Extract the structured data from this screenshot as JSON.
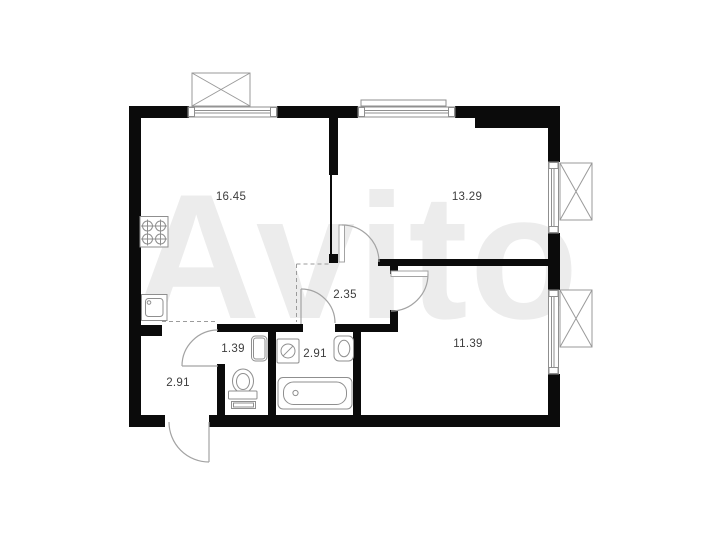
{
  "watermark": {
    "text": "Avito"
  },
  "colors": {
    "wall": "#0b0b0b",
    "fixture_outline": "#8f8f8f",
    "balcony_outline": "#9a9a9a",
    "door_arc": "#a3a3a3",
    "label_text": "#3d3d3d",
    "watermark_gray": "#ececec",
    "background": "#ffffff"
  },
  "rooms": [
    {
      "name": "kitchen",
      "area": "16.45"
    },
    {
      "name": "living-room",
      "area": "13.29"
    },
    {
      "name": "hallway",
      "area": "2.35"
    },
    {
      "name": "wc",
      "area": "1.39"
    },
    {
      "name": "bathroom",
      "area": "2.91"
    },
    {
      "name": "entry-corridor",
      "area": "2.91"
    },
    {
      "name": "bedroom",
      "area": "11.39"
    }
  ],
  "fixtures": [
    "stove-icon",
    "kitchen-sink-icon",
    "toilet-icon",
    "wc-basin-icon",
    "washing-machine-icon",
    "bathroom-sink-icon",
    "bathtub-icon"
  ]
}
